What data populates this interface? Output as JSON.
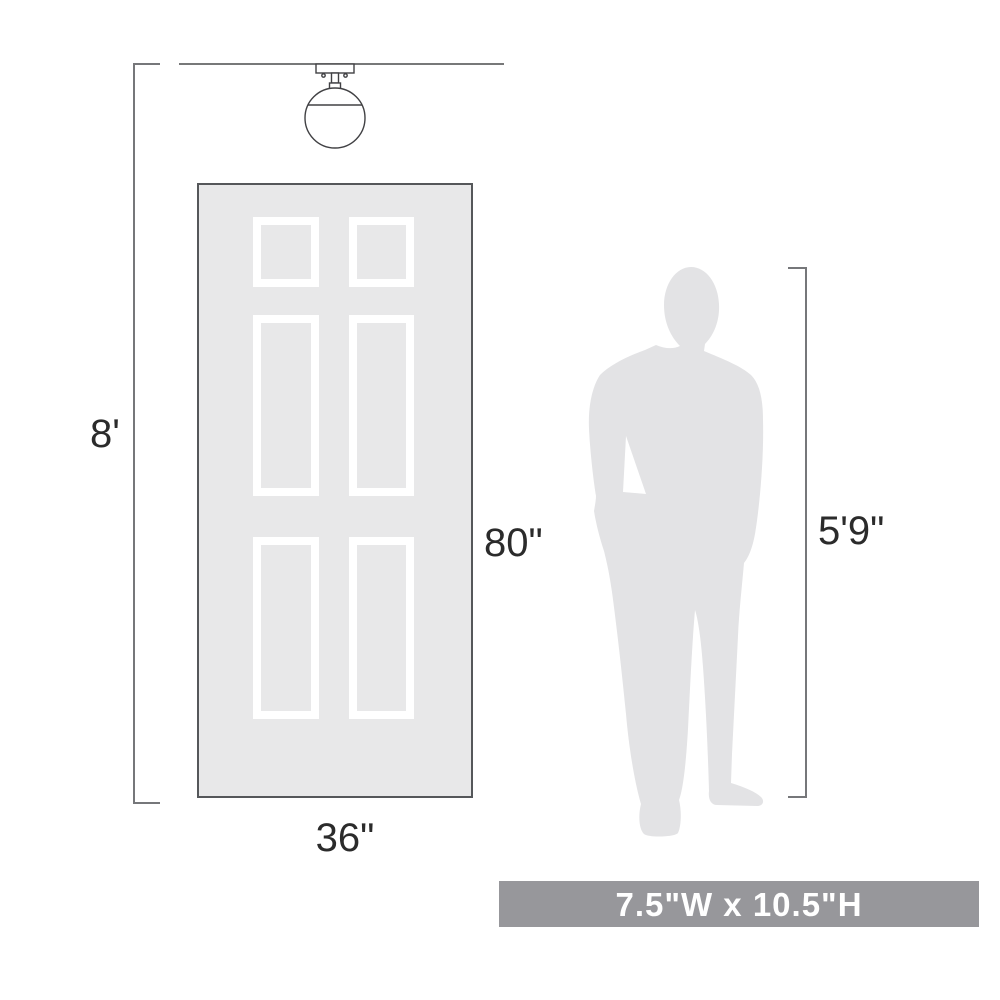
{
  "diagram": {
    "title": "light-fixture-scale-diagram",
    "labels": {
      "ceiling_height": "8'",
      "door_height": "80\"",
      "door_width": "36\"",
      "person_height": "5'9\""
    },
    "banner": {
      "size_label": "7.5\"W x 10.5\"H",
      "bg_color": "#97979b",
      "text_color": "#ffffff"
    },
    "icons": [
      "flush-mount-globe-light-icon",
      "six-panel-door",
      "person-silhouette"
    ],
    "colors": {
      "background": "#ffffff",
      "door_fill": "#e8e8e9",
      "door_border": "#55575a",
      "panel_frame": "#ffffff",
      "silhouette_fill": "#e3e3e5",
      "line_art": "#414144",
      "dimension_line": "#76777a",
      "label_text": "#2b2b2b"
    }
  }
}
